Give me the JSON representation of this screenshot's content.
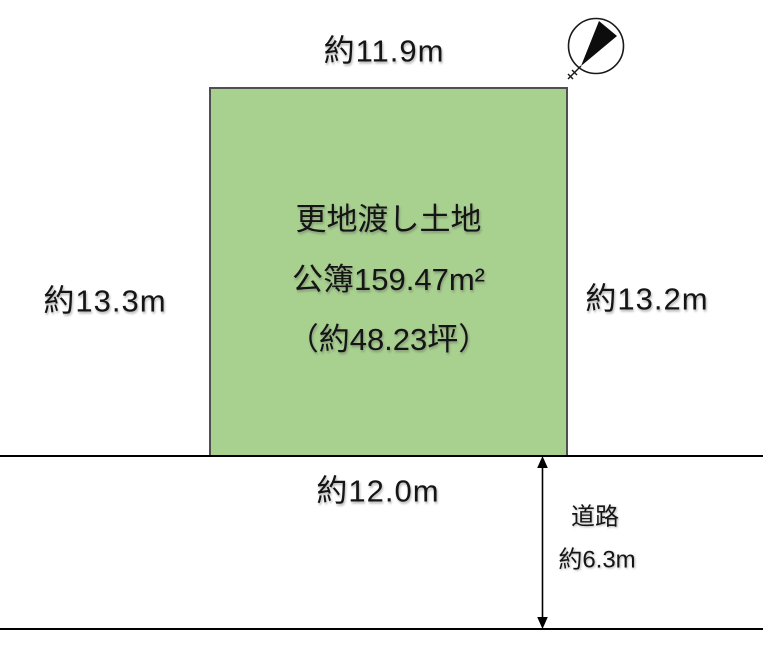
{
  "diagram": {
    "title": "land-plot-diagram",
    "plot": {
      "line1": "更地渡し土地",
      "line2": "公簿159.47m²",
      "line3": "（約48.23坪）",
      "fill_color": "#a8d08f",
      "border_color": "#4f4f4f"
    },
    "dimensions": {
      "top": "約11.9m",
      "left": "約13.3m",
      "right": "約13.2m",
      "bottom": "約12.0m"
    },
    "road": {
      "name": "道路",
      "width": "約6.3m"
    },
    "icons": {
      "compass": "north-arrow",
      "road_span_arrow": "double-headed-vertical-arrow"
    },
    "colors": {
      "line": "#000000",
      "text": "#151515",
      "background": "#ffffff"
    }
  }
}
